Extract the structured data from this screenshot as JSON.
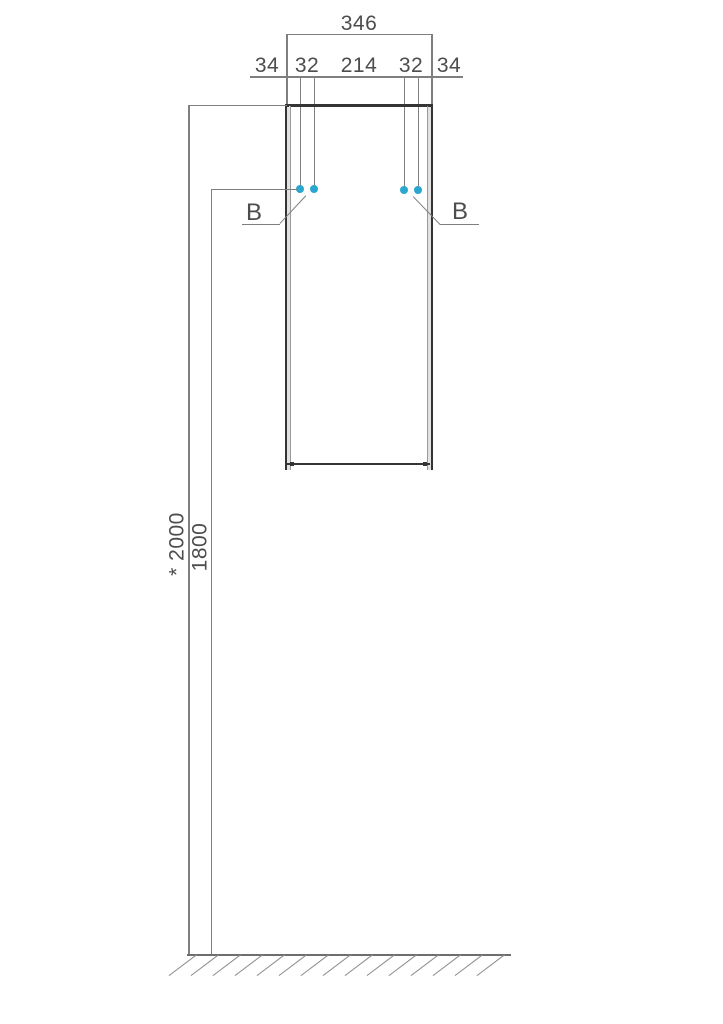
{
  "drawing": {
    "type": "cabinet-installation-dimension-drawing",
    "dim_width_total": "346",
    "dim_segments": [
      "34",
      "32",
      "214",
      "32",
      "34"
    ],
    "dim_height_total": "* 2000",
    "dim_height_holes": "1800",
    "callout_left": "B",
    "callout_right": "B"
  },
  "colors": {
    "dim_line": "#7f7f7f",
    "outline_dark": "#343434",
    "panel_fill": "#e2e2e2",
    "text": "#4d4d4d",
    "mount_dot": "#2ba6ce",
    "hatch": "#8a8a8a"
  },
  "mount_points": [
    {
      "x": 300,
      "y": 189
    },
    {
      "x": 314,
      "y": 189
    },
    {
      "x": 404,
      "y": 190
    },
    {
      "x": 418,
      "y": 190
    }
  ],
  "floor": {
    "hatch_count": 15,
    "start_x": 197,
    "spacing": 22,
    "y": 954.2
  }
}
